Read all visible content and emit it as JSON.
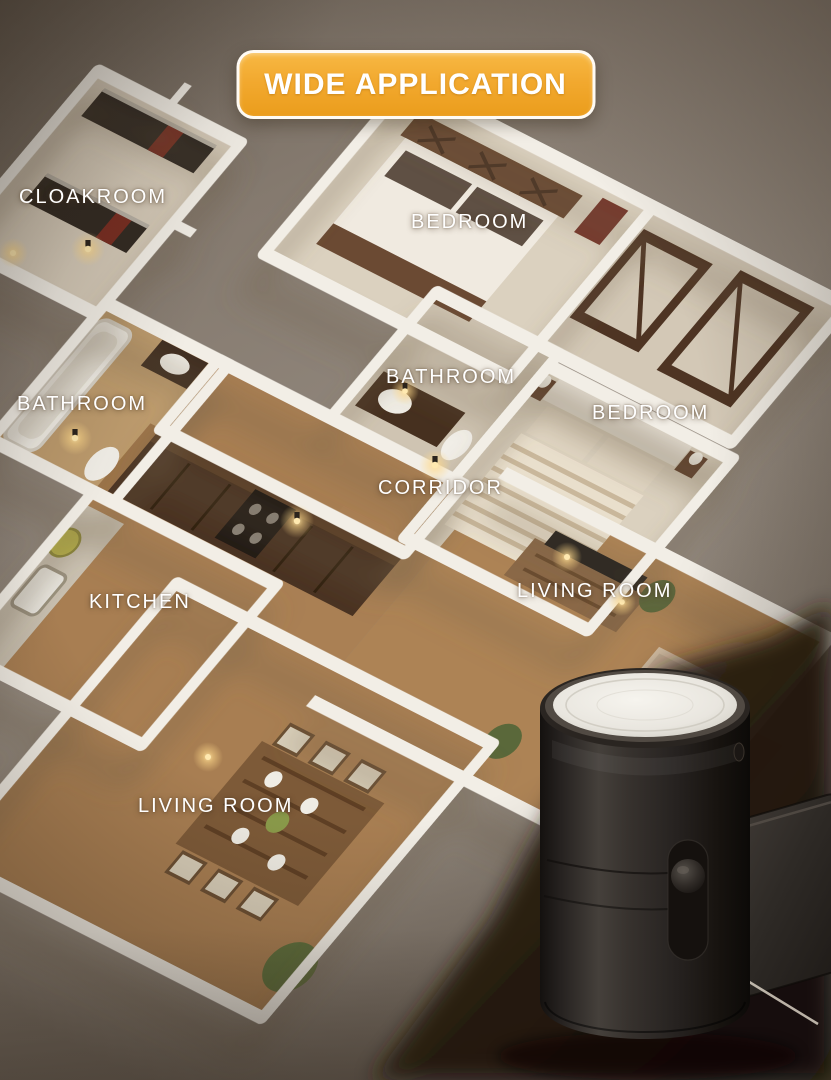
{
  "banner": {
    "label": "WIDE APPLICATION"
  },
  "floorplan": {
    "style": "3d-isometric-apartment-render",
    "rooms": [
      {
        "id": "cloakroom",
        "label": "CLOAKROOM"
      },
      {
        "id": "bedroom-top",
        "label": "BEDROOM"
      },
      {
        "id": "bathroom-left",
        "label": "BATHROOM"
      },
      {
        "id": "bathroom-middle",
        "label": "BATHROOM"
      },
      {
        "id": "bedroom-right",
        "label": "BEDROOM"
      },
      {
        "id": "corridor",
        "label": "CORRIDOR"
      },
      {
        "id": "kitchen",
        "label": "KITCHEN"
      },
      {
        "id": "living-room-right",
        "label": "LIVING ROOM"
      },
      {
        "id": "living-room-bottom",
        "label": "LIVING ROOM"
      }
    ]
  },
  "product": {
    "name": "plug-in night light",
    "visible_parts": [
      "white-light-lens",
      "cylindrical-body",
      "slider-switch",
      "wall-plug"
    ]
  },
  "colors": {
    "banner_orange_top": "#f7b843",
    "banner_orange_bottom": "#eb9d1c",
    "banner_border": "#ffffff",
    "banner_text": "#ffffff",
    "room_label_text": "#ffffff",
    "background_taupe": "#8d8378",
    "wall_white": "#f2eee6",
    "wood_floor": "#a87e52",
    "carpet_beige": "#d9cfbd",
    "night_light_glow": "#ffd98a",
    "product_body": "#2b2725",
    "product_lens": "#efede7",
    "backdrop_shadow": "#1a120b"
  }
}
